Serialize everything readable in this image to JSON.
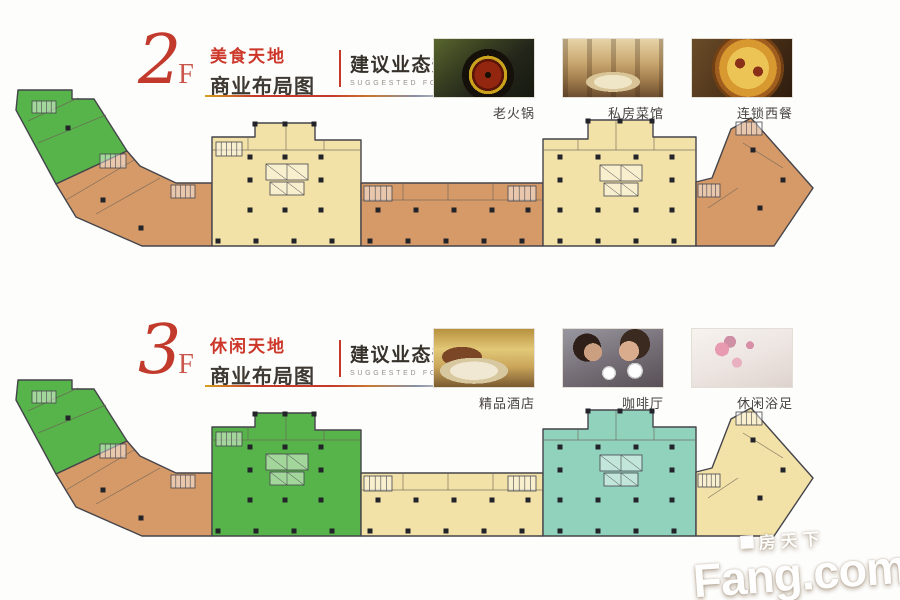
{
  "colors": {
    "green": "#57b44a",
    "orange": "#d59a68",
    "cream": "#f2e2a7",
    "teal": "#90d2bc",
    "outline": "#45444b",
    "accent_red": "#c5392b",
    "column": "#23232a"
  },
  "floors": [
    {
      "id": "2f",
      "number": "2",
      "suffix": "F",
      "theme_title": "美食天地",
      "subtitle": "商业布局图",
      "plan_badge": {
        "title": "建议业态规划图",
        "subtitle": "SUGGESTED FORMAT PLAN"
      },
      "photos": [
        {
          "label": "老火锅",
          "name": "hotpot"
        },
        {
          "label": "私房菜馆",
          "name": "private-restaurant"
        },
        {
          "label": "连锁西餐",
          "name": "western-chain"
        }
      ],
      "zone_colors": {
        "arm_left_upper": "green",
        "arm_left_lower": "orange",
        "left_block": "cream",
        "mid_band": "orange",
        "right_block": "cream",
        "right_arm": "orange"
      }
    },
    {
      "id": "3f",
      "number": "3",
      "suffix": "F",
      "theme_title": "休闲天地",
      "subtitle": "商业布局图",
      "plan_badge": {
        "title": "建议业态规划图",
        "subtitle": "SUGGESTED FORMAT PLAN"
      },
      "photos": [
        {
          "label": "精品酒店",
          "name": "boutique-hotel"
        },
        {
          "label": "咖啡厅",
          "name": "coffee-shop"
        },
        {
          "label": "休闲浴足",
          "name": "foot-spa"
        }
      ],
      "zone_colors": {
        "arm_left_upper": "green",
        "arm_left_lower": "orange",
        "left_block": "green",
        "mid_band": "cream",
        "right_block": "teal",
        "right_arm": "cream"
      }
    }
  ],
  "watermark": {
    "cn": "房天下",
    "en": "Fang.com"
  }
}
